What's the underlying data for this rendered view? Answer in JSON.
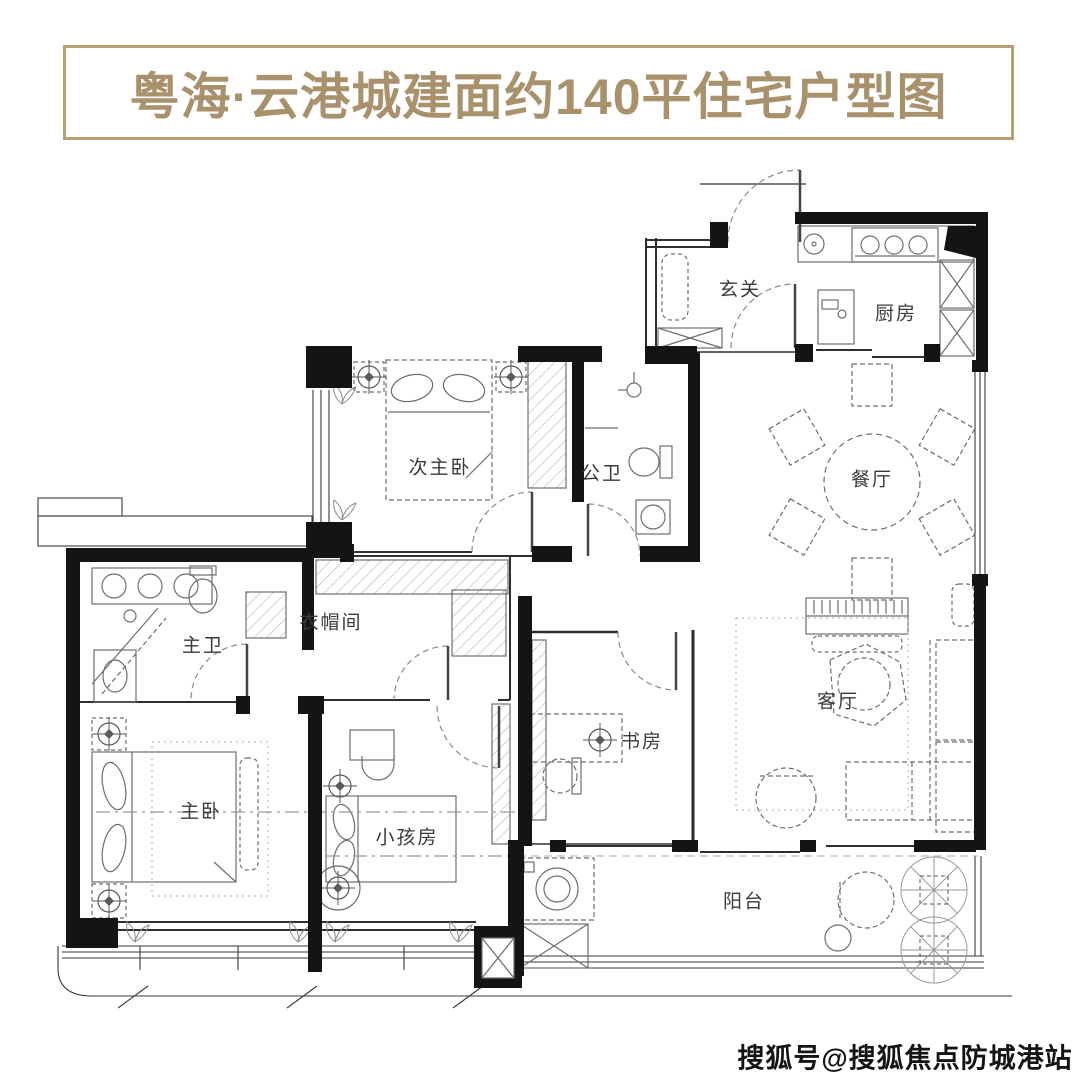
{
  "title": "粤海·云港城建面约140平住宅户型图",
  "watermark": "搜狐号@搜狐焦点防城港站",
  "colors": {
    "accent_gold": "#a8916b",
    "banner_border_gold": "#b3a074",
    "wall_black": "#141414",
    "furniture_gray": "#6e6e6e",
    "background": "#ffffff"
  },
  "rooms": [
    {
      "label": "玄关"
    },
    {
      "label": "厨房"
    },
    {
      "label": "次主卧"
    },
    {
      "label": "公卫"
    },
    {
      "label": "餐厅"
    },
    {
      "label": "主卫"
    },
    {
      "label": "衣帽间"
    },
    {
      "label": "书房"
    },
    {
      "label": "客厅"
    },
    {
      "label": "主卧"
    },
    {
      "label": "小孩房"
    },
    {
      "label": "阳台"
    }
  ]
}
